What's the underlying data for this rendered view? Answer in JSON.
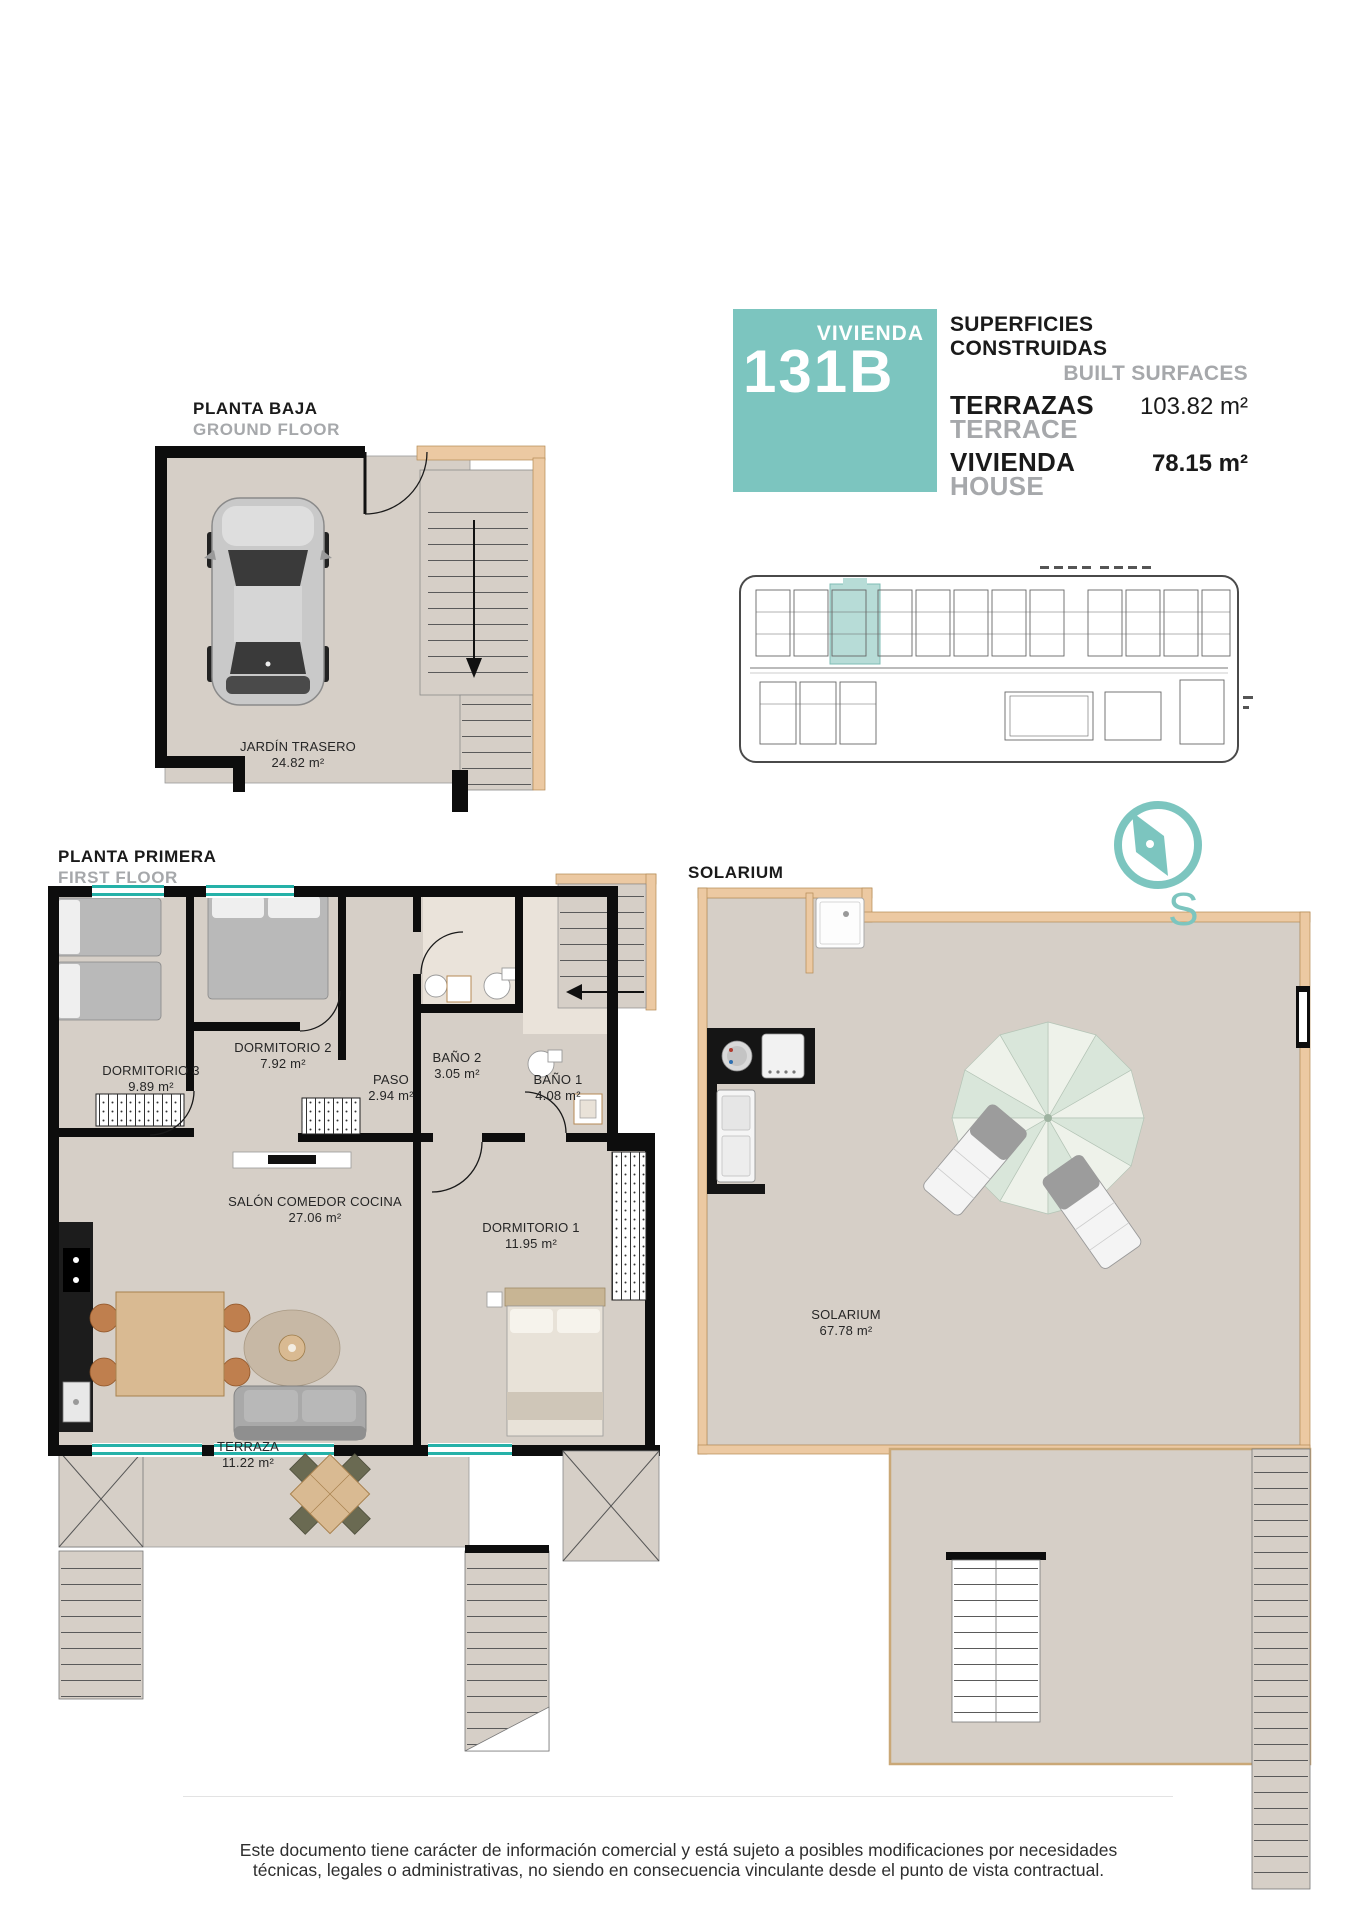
{
  "header": {
    "unit_word": "VIVIENDA",
    "unit_number": "131B",
    "surfaces_title": "SUPERFICIES CONSTRUIDAS",
    "surfaces_title_en": "BUILT SURFACES",
    "terrace_label": "TERRAZAS",
    "terrace_label_en": "TERRACE",
    "terrace_value": "103.82 m²",
    "house_label": "VIVIENDA",
    "house_label_en": "HOUSE",
    "house_value": "78.15 m²"
  },
  "plans": {
    "ground": {
      "title": "PLANTA BAJA",
      "title_en": "GROUND FLOOR",
      "rooms": [
        {
          "name": "JARDÍN TRASERO",
          "area": "24.82 m²"
        }
      ]
    },
    "first": {
      "title": "PLANTA PRIMERA",
      "title_en": "FIRST FLOOR",
      "rooms": [
        {
          "name": "DORMITORIO 3",
          "area": "9.89 m²"
        },
        {
          "name": "DORMITORIO 2",
          "area": "7.92 m²"
        },
        {
          "name": "PASO",
          "area": "2.94 m²"
        },
        {
          "name": "BAÑO 2",
          "area": "3.05 m²"
        },
        {
          "name": "BAÑO 1",
          "area": "4.08 m²"
        },
        {
          "name": "SALÓN COMEDOR COCINA",
          "area": "27.06 m²"
        },
        {
          "name": "DORMITORIO 1",
          "area": "11.95 m²"
        },
        {
          "name": "TERRAZA",
          "area": "11.22 m²"
        }
      ]
    },
    "solarium": {
      "title": "SOLARIUM",
      "rooms": [
        {
          "name": "SOLARIUM",
          "area": "67.78 m²"
        }
      ]
    }
  },
  "compass": {
    "letter": "S"
  },
  "footer": {
    "line1": "Este documento tiene carácter de información comercial y está sujeto a posibles modificaciones por necesidades",
    "line2": "técnicas, legales o administrativas, no siendo en consecuencia vinculante desde el punto de vista contractual."
  },
  "colors": {
    "accent": "#7cc5bf",
    "accent_light": "#b7dcd7",
    "floor": "#d6cfc7",
    "wall_accent": "#ecc9a2",
    "muted_text": "#a6a8ab"
  }
}
